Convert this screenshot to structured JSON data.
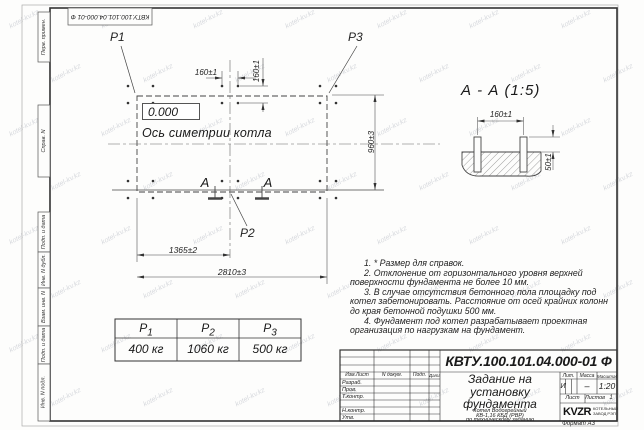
{
  "watermark": "kotel-kv.kz",
  "frame": {
    "top_stamp": "КВТУ.100.101.04.000-01 Ф",
    "left_labels": [
      "Перв. примен.",
      "Справ. N",
      "Подп. и дата",
      "Инв. N дубл.",
      "Взам. инв. N",
      "Подп. и дата",
      "Инв. N подл."
    ],
    "format_label": "Формат А3"
  },
  "plan": {
    "labels": {
      "p1": "P1",
      "p2": "P2",
      "p3": "P3"
    },
    "elevation": "0.000",
    "axis_label": "Ось симетрии котла",
    "section_letter": "А",
    "dims": {
      "pitch_x": "160±1",
      "pitch_y": "160±1",
      "width_mid": "1365±2",
      "width_total": "2810±3",
      "depth": "960±3"
    }
  },
  "section_view": {
    "title": "А - А (1:5)",
    "dims": {
      "bolt_pitch": "160±1",
      "protrusion": "50±1"
    }
  },
  "notes": [
    "1. * Размер для справок.",
    "2. Отклонение от горизонтального уровня верхней поверхности фундамента не более 10 мм.",
    "3. В случае отсутствия бетонного пола площадку под котел забетонировать. Расстояние от осей крайних колонн до края бетонной подушки 500 мм.",
    "4. Фундамент под котел разрабатывает проектная организация по нагрузкам на фундамент."
  ],
  "load_table": {
    "headers": [
      {
        "base": "P",
        "sub": "1"
      },
      {
        "base": "P",
        "sub": "2"
      },
      {
        "base": "P",
        "sub": "3"
      }
    ],
    "values": [
      "400 кг",
      "1060 кг",
      "500 кг"
    ]
  },
  "title_block": {
    "designation": "КВТУ.100.101.04.000-01 Ф",
    "doc_title_lines": [
      "Задание на",
      "установку",
      "фундамента"
    ],
    "product_lines": [
      "Котел Водогрейный",
      "КВ-1,16 КБД (РВР)",
      "по техническому заданию"
    ],
    "columns_header": [
      "Изм.Лист",
      "N докум.",
      "Подп.",
      "Дата"
    ],
    "roles": [
      "Разраб.",
      "Пров.",
      "Т.контр.",
      "",
      "Н.контр.",
      "Утв."
    ],
    "lit_header": "Лит.",
    "mass_header": "Масса",
    "scale_header": "Масштаб",
    "lit_value": "И",
    "mass_value": "–",
    "scale_value": "1:20",
    "sheet_label": "Лист",
    "sheets_label": "Листов",
    "sheets_value": "1",
    "logo_text": "KVZR",
    "logo_caption_lines": [
      "КОТЕЛЬНЫЙ",
      "ЗАВОД РЭП"
    ]
  }
}
